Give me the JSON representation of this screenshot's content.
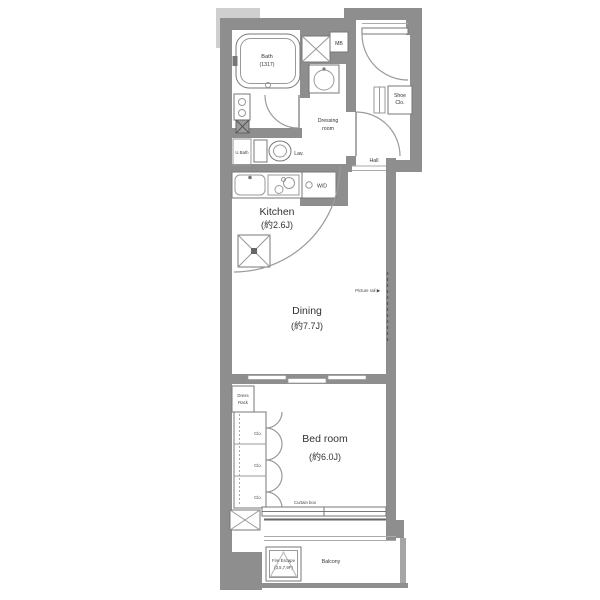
{
  "plan": {
    "rooms": {
      "bath": {
        "name": "Bath",
        "size": "(1317)"
      },
      "kitchen": {
        "name": "Kitchen",
        "size": "(約2.6J)"
      },
      "dining": {
        "name": "Dining",
        "size": "(約7.7J)"
      },
      "bedroom": {
        "name": "Bed room",
        "size": "(約6.0J)"
      },
      "dressing": {
        "line1": "Dressing",
        "line2": "room"
      },
      "hall": {
        "name": "Hall"
      },
      "balcony": {
        "name": "Balcony"
      }
    },
    "fixtures": {
      "meter_box": "MB",
      "shoe_closet_line1": "Shoe",
      "shoe_closet_line2": "Clo.",
      "lavatory": "Lav.",
      "unit_bath": "U.Bath",
      "washer_dryer": "W/D",
      "closet": "Clo.",
      "dress_rack_line1": "Dress",
      "dress_rack_line2": "Rack",
      "curtain_box": "Curtain box",
      "picture_rail": "Picture rail ▶",
      "fire_escape_line1": "Fire Escape",
      "fire_escape_line2": "(3,5,7,9F)"
    },
    "colors": {
      "wall": "#8e8e8e",
      "wall_light": "#cfcfcf",
      "line": "#666666",
      "text": "#333333"
    }
  }
}
